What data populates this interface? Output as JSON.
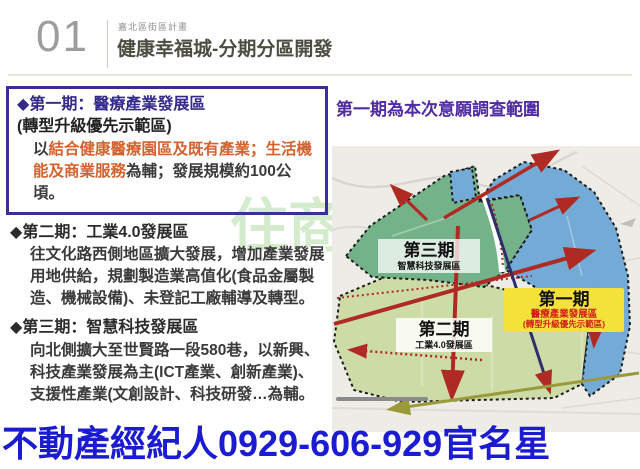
{
  "header": {
    "number": "01",
    "eyebrow": "嘉北區街區計畫",
    "title": "健康幸福城-分期分區開發"
  },
  "left": {
    "phase1": {
      "bullet": "◆",
      "heading": "第一期：醫療產業發展區",
      "subheading": "(轉型升級優先示範區)",
      "body_segments": [
        {
          "text": "以",
          "color": "dark"
        },
        {
          "text": "結合健康醫療園區及既有產業；生活機能及商業服務",
          "color": "orange"
        },
        {
          "text": "為輔；發展規模約100公頃。",
          "color": "dark"
        }
      ]
    },
    "phase2": {
      "bullet": "◆",
      "heading": "第二期：工業4.0發展區",
      "body": "往文化路西側地區擴大發展，增加產業發展用地供給，規劃製造業高值化(食品金屬製造、機械設備)、未登記工廠輔導及轉型。"
    },
    "phase3": {
      "bullet": "◆",
      "heading": "第三期：智慧科技發展區",
      "body": "向北側擴大至世賢路一段580巷，以新興、科技產業發展為主(ICT產業、創新產業)、支援性產業(文創設計、科技研發…為輔。"
    }
  },
  "right": {
    "map_title": "第一期為本次意願調查範圍",
    "map_labels": {
      "phase3": {
        "title": "第三期",
        "subtitle": "智慧科技發展區"
      },
      "phase2": {
        "title": "第二期",
        "subtitle": "工業4.0發展區"
      },
      "phase1": {
        "title": "第一期",
        "subtitle": "醫療產業發展區",
        "subtitle2": "(轉型升級優先示範區)"
      }
    }
  },
  "watermarks": {
    "background_text": "住商",
    "bottom_banner": "不動產經紀人0929-606-929官名星"
  },
  "colors": {
    "accent_purple_border": "#3b2f96",
    "heading_purple": "#332a8a",
    "map_title_purple": "#4f2ba4",
    "highlight_orange": "#d4622e",
    "zone_green": "#74b389",
    "zone_light_green": "#cddba6",
    "zone_blue": "#74abd6",
    "label_yellow": "#f4e23b",
    "arrow_red": "#b02a24",
    "banner_blue": "#1b1bd1"
  }
}
